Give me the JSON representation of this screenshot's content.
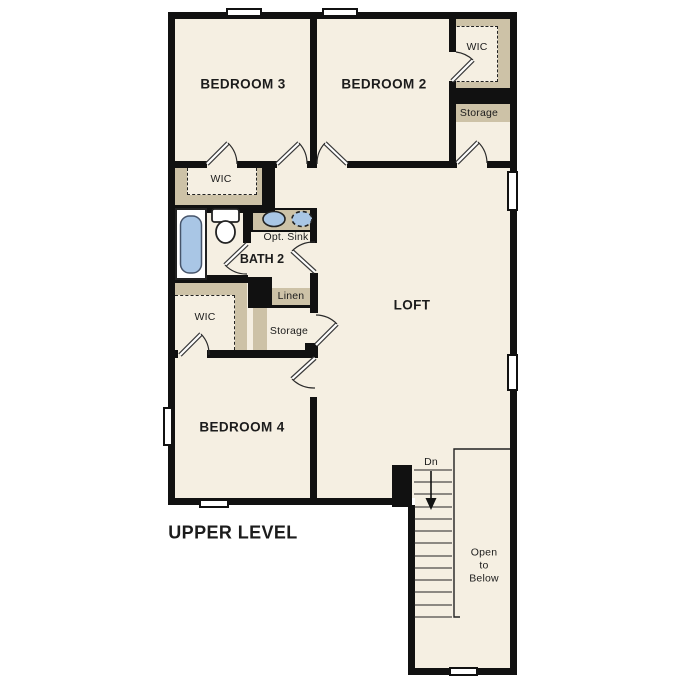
{
  "title": "UPPER LEVEL",
  "colors": {
    "floor": "#f5efe2",
    "band": "#cdc2a7",
    "wall": "#111111",
    "fixture": "#a9c6e5"
  },
  "rooms": {
    "bedroom3": {
      "label": "BEDROOM 3"
    },
    "bedroom2": {
      "label": "BEDROOM 2"
    },
    "bedroom4": {
      "label": "BEDROOM 4"
    },
    "loft": {
      "label": "LOFT"
    },
    "bath2": {
      "label": "BATH 2"
    }
  },
  "closets": {
    "wic_bedroom3": {
      "label": "WIC"
    },
    "wic_bedroom2": {
      "label": "WIC"
    },
    "wic_bedroom4": {
      "label": "WIC"
    },
    "storage_bedroom2": {
      "label": "Storage"
    },
    "storage_loft": {
      "label": "Storage"
    },
    "linen": {
      "label": "Linen"
    }
  },
  "annotations": {
    "opt_sink": "Opt. Sink",
    "stairs_down": "Dn",
    "open_to_below": "Open\nto\nBelow"
  }
}
